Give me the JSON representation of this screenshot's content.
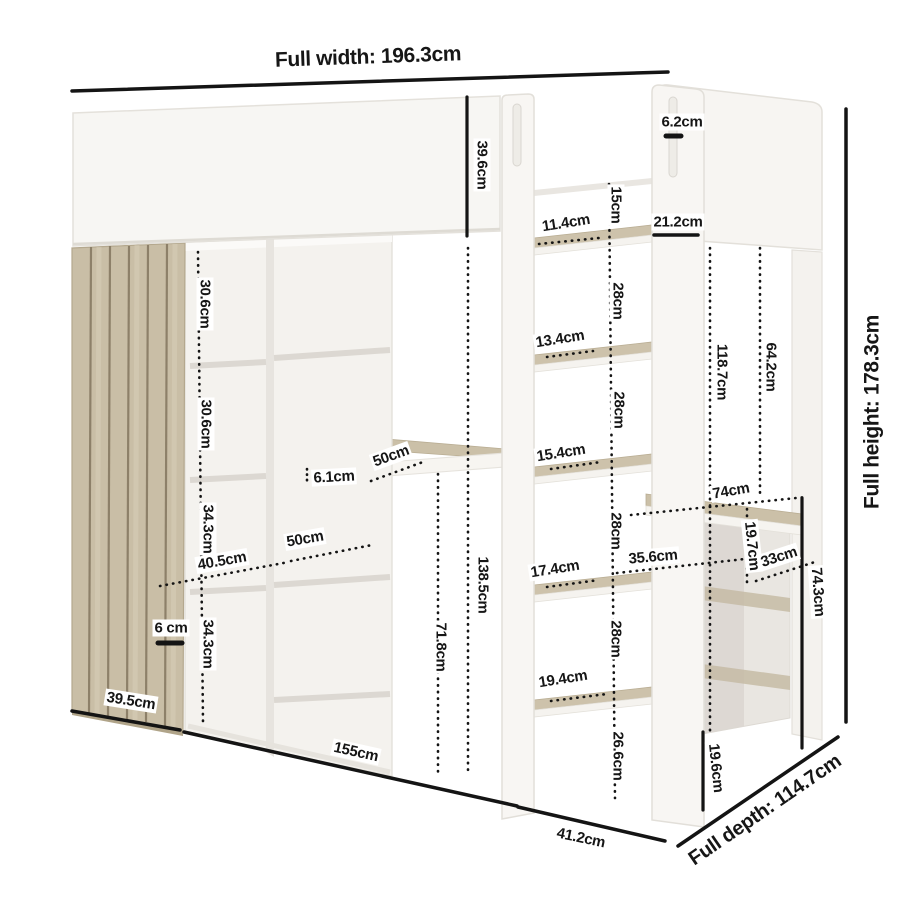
{
  "labels": {
    "full_width": "Full width: 196.3cm",
    "full_height": "Full height: 178.3cm",
    "full_depth": "Full depth: 114.7cm",
    "headboard_height": "39.6cm",
    "handle_slot_width": "6.2cm",
    "end_panel_width": "21.2cm",
    "step_1_depth": "11.4cm",
    "step_2_depth": "13.4cm",
    "step_3_depth": "15.4cm",
    "step_4_depth": "17.4cm",
    "step_5_depth": "19.4cm",
    "step_gap_top": "15cm",
    "step_gap": "28cm",
    "step_gap_bottom": "26.6cm",
    "cubby_height_a": "30.6cm",
    "cubby_height_b": "34.3cm",
    "desk_thickness": "6.1cm",
    "depth_50": "50cm",
    "depth_40_5": "40.5cm",
    "gap_6": "6 cm",
    "base_39_5": "39.5cm",
    "base_155": "155cm",
    "base_41_2": "41.2cm",
    "height_138_5": "138.5cm",
    "height_71_8": "71.8cm",
    "height_118_7": "118.7cm",
    "height_64_2": "64.2cm",
    "width_74": "74cm",
    "width_35_6": "35.6cm",
    "height_19_7": "19.7cm",
    "width_33": "33cm",
    "height_74_3": "74.3cm",
    "height_19_6": "19.6cm"
  },
  "colors": {
    "dimension_line": "#141414",
    "label_text": "#161616",
    "panel_white": "#f7f5f2",
    "panel_edge": "#e3e0da",
    "wood_light": "#cdc2ab",
    "wood_dark": "#8d8069",
    "background": "#ffffff"
  }
}
